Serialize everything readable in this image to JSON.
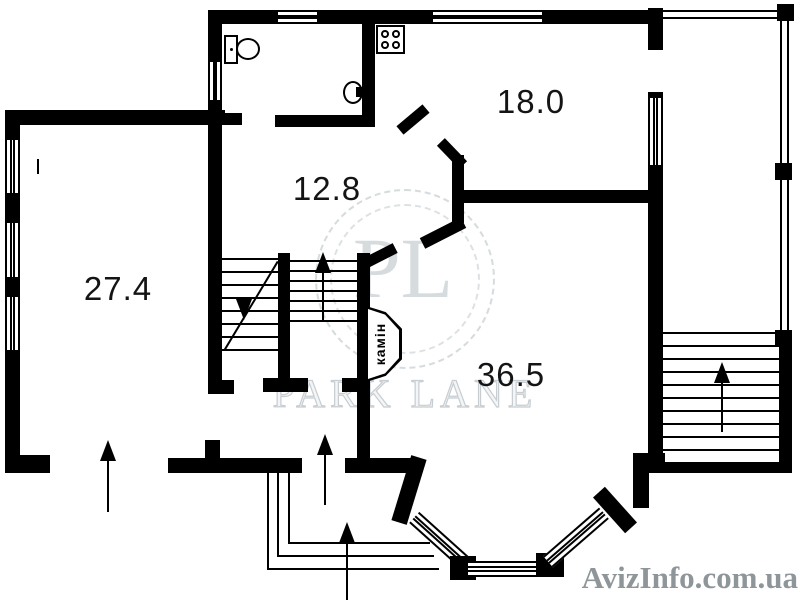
{
  "plan": {
    "background": "#ffffff",
    "wall_color": "#000000",
    "rooms": [
      {
        "label": "27.4"
      },
      {
        "label": "12.8"
      },
      {
        "label": "18.0"
      },
      {
        "label": "36.5"
      }
    ],
    "fireplace_label": "камін"
  },
  "watermark": {
    "monogram": "PL",
    "brand": "PARK LANE",
    "site": "AvizInfo.com.ua",
    "monogram_color": "#cdd3d7",
    "brand_outline_color": "#c7cdd1",
    "site_color": "#8e969a"
  }
}
